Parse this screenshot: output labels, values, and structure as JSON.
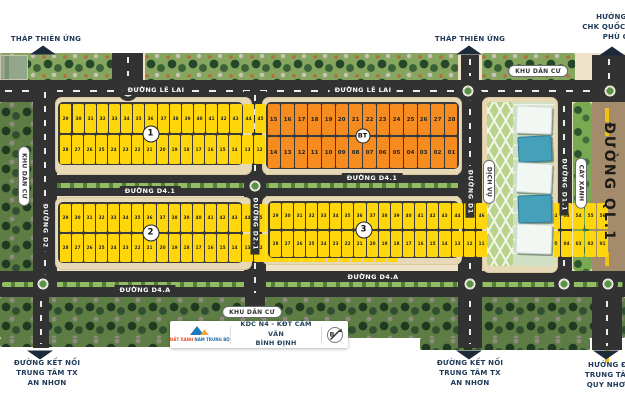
{
  "directions": {
    "thap_left": "THÁP THIÊN ỨNG",
    "thap_mid": "THÁP THIÊN ỨNG",
    "airport": {
      "l1": "HƯỚNG ĐI",
      "l2": "CHK QUỐC TẾ",
      "l3": "PHÙ CÁT"
    },
    "an_nhon": {
      "l1": "ĐƯỜNG KẾT NỐI",
      "l2": "TRUNG TÂM TX",
      "l3": "AN NHƠN"
    },
    "quy_nhon": {
      "l1": "HƯỚNG ĐI",
      "l2": "TRUNG TÂM",
      "l3": "QUY NHƠN"
    }
  },
  "roads": {
    "le_lai": "ĐƯỜNG LÊ LAI",
    "d41": "ĐƯỜNG D4.1",
    "d4a": "ĐƯỜNG D4.A",
    "d2": "ĐƯỜNG D2",
    "d21": "ĐƯỜNG D2.1",
    "d1": "ĐƯỜNG D1",
    "d11": "ĐƯỜNG D1.1",
    "ql1": "ĐƯỜNG QL.1"
  },
  "areas": {
    "khu_dan_cu": "KHU DÂN CƯ",
    "cay_xanh": "CÂY XANH",
    "dich_vu": "DỊCH VỤ"
  },
  "blocks": [
    {
      "badge": "1",
      "type": "yellow",
      "top": [
        "29",
        "",
        "30",
        "31",
        "32",
        "33",
        "34",
        "35",
        "36",
        "37",
        "38",
        "39",
        "40",
        "41",
        "42",
        "43",
        "44",
        "45",
        "46",
        "47",
        "48",
        "49",
        "50",
        "51",
        "52",
        "53",
        "54"
      ],
      "bottom": [
        "28",
        "27",
        "26",
        "25",
        "24",
        "23",
        "22",
        "21",
        "20",
        "19",
        "18",
        "17",
        "16",
        "15",
        "14",
        "13",
        "12",
        "11",
        "10",
        "09",
        "08",
        "07",
        "06",
        "05",
        "04",
        "03",
        "02",
        "01"
      ]
    },
    {
      "badge": "BT",
      "type": "orange",
      "top": [
        "15",
        "16",
        "17",
        "18",
        "19",
        "20",
        "21",
        "22",
        "23",
        "24",
        "25",
        "26",
        "27",
        "28"
      ],
      "bottom": [
        "14",
        "13",
        "12",
        "11",
        "10",
        "09",
        "08",
        "07",
        "06",
        "05",
        "04",
        "03",
        "02",
        "01"
      ]
    },
    {
      "badge": "2",
      "type": "yellow",
      "top": [
        "29",
        "30",
        "31",
        "32",
        "33",
        "34",
        "35",
        "36",
        "37",
        "38",
        "39",
        "40",
        "41",
        "42",
        "43",
        "44",
        "45",
        "46",
        "47",
        "48",
        "49",
        "50",
        "51",
        "52",
        "53",
        "54",
        "55",
        "56"
      ],
      "bottom": [
        "28",
        "27",
        "26",
        "25",
        "24",
        "23",
        "22",
        "21",
        "20",
        "19",
        "18",
        "17",
        "16",
        "15",
        "14",
        "13",
        "12",
        "11",
        "10",
        "09",
        "08",
        "07",
        "06",
        "05",
        "04",
        "03",
        "02",
        "01"
      ]
    },
    {
      "badge": "3",
      "type": "yellow",
      "top": [
        "29",
        "30",
        "31",
        "32",
        "33",
        "34",
        "35",
        "36",
        "37",
        "38",
        "39",
        "40",
        "41",
        "42",
        "43",
        "44",
        "45",
        "46",
        "47",
        "48",
        "49",
        "50",
        "51",
        "52",
        "53",
        "54",
        "55",
        "56"
      ],
      "bottom": [
        "28",
        "27",
        "26",
        "25",
        "24",
        "23",
        "22",
        "21",
        "20",
        "19",
        "18",
        "17",
        "16",
        "15",
        "14",
        "13",
        "12",
        "11",
        "10",
        "09",
        "08",
        "07",
        "06",
        "05",
        "04",
        "03",
        "02",
        "01"
      ]
    }
  ],
  "footer": {
    "logo_part1": "ĐẤT XANH",
    "logo_part2": "NAM TRUNG BỘ",
    "project_l1": "KDC N4 - KĐT CẨM VĂN",
    "project_l2": "BÌNH ĐỊNH",
    "compass_letter": "B"
  },
  "colors": {
    "lot_yellow": "#FFD60B",
    "lot_orange": "#F68B1F",
    "road": "#323232",
    "navy_label": "#203A58",
    "tree_dark": "#24462A",
    "sand": "#E7D9B6"
  }
}
